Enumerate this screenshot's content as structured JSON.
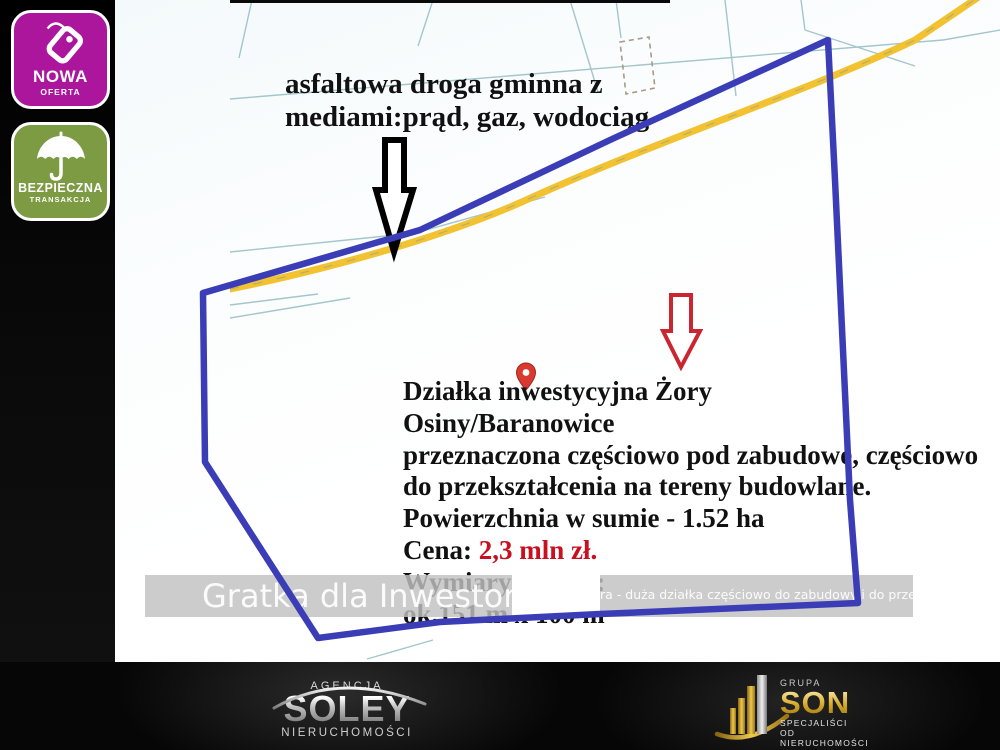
{
  "badges": {
    "new_offer": {
      "title": "NOWA",
      "subtitle": "OFERTA",
      "color": "#ab169c"
    },
    "safe_transaction": {
      "title": "BEZPIECZNA",
      "subtitle": "TRANSAKCJA",
      "color": "#7d9b43"
    }
  },
  "map": {
    "road_note": {
      "line1": "asfaltowa droga gminna z",
      "line2": "mediami:prąd, gaz, wodociąg"
    },
    "plot_info": {
      "line1": "Działka inwestycyjna Żory",
      "line2": "Osiny/Baranowice",
      "line3": "przeznaczona częściowo pod zabudowę, częściowo",
      "line4": "do przekształcenia na tereny budowlane.",
      "line5": "Powierzchnia w sumie - 1.52 ha",
      "price_label": "Cena: ",
      "price_value": "2,3 mln zł.",
      "line7": "Wymiary działki:",
      "line8": "ok.151 m x 100 m"
    },
    "colors": {
      "plot_outline": "#3a3db6",
      "road": "#f2c230",
      "parcel_line": "#a3c6cc",
      "building_dashed": "#a89a88",
      "building_solid": "#b5ac9e",
      "price_text": "#c81020",
      "marker_red": "#d93a30"
    }
  },
  "watermark": {
    "big": "Gratka dla Inwestora",
    "small": "ra - duża działka częściowo do zabudowy i do przekształ"
  },
  "footer": {
    "soley": {
      "top": "AGENCJA",
      "name": "SOLEY",
      "bottom": "NIERUCHOMOŚCI"
    },
    "son": {
      "top": "GRUPA",
      "name": "SON",
      "bottom1": "SPECJALIŚCI",
      "bottom2": "OD NIERUCHOMOŚCI"
    }
  }
}
